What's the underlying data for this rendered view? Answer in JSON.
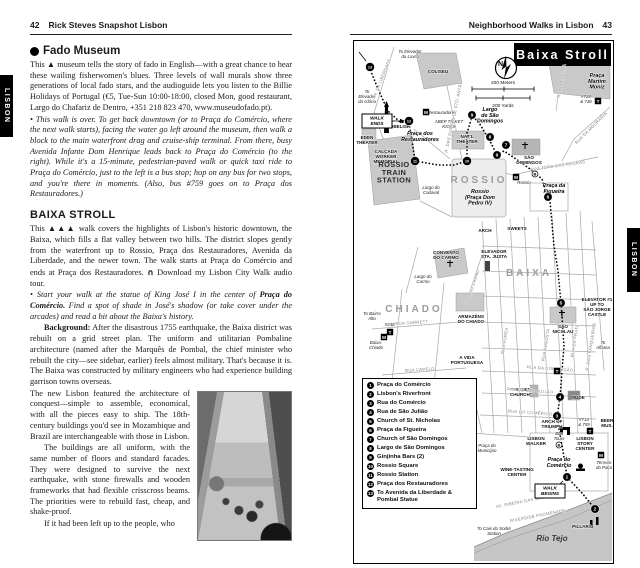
{
  "colors": {
    "ink": "#1a1a1a",
    "paper": "#ffffff",
    "map_building_gray": "#c9c9c9",
    "river_gray": "#c6c6c6",
    "tab_black": "#000000"
  },
  "page_left": {
    "page_number": "42",
    "header": "Rick Steves Snapshot Lisbon",
    "side_tab": "LISBON",
    "fado": {
      "marker_icon": "filled-circle",
      "title": "Fado Museum",
      "body": "This ▲ museum tells the story of fado in English—with a great chance to hear these wailing fisherwomen's blues. Three levels of wall murals show three generations of local fado stars, and the audioguide lets you listen to the Billie Holidays of Portugal (€5, Tue-Sun 10:00-18:00, closed Mon, good restaurant, Largo do Chafariz de Dentro, +351 218 823 470, www.museudofado.pt).",
      "walk_note": "• This walk is over. To get back downtown (or to Praça do Comércio, where the next walk starts), facing the water go left around the museum, then walk a block to the main waterfront drag and cruise-ship terminal. From there, busy Avenida Infante Dom Henrique leads back to Praça do Comércio (to the right). While it's a 15-minute, pedestrian-paved walk or quick taxi ride to Praça do Comércio, just to the left is a bus stop; hop on any bus for two stops, and you're there in moments. (Also, bus #759 goes on to Praça dos Restauradores.)"
    },
    "baixa": {
      "title": "BAIXA STROLL",
      "intro": "This ▲▲▲ walk covers the highlights of Lisbon's historic downtown, the Baixa, which fills a flat valley between two hills. The district slopes gently from the waterfront up to Rossio, Praça dos Restauradores, Avenida da Liberdade, and the newer town. The walk starts at Praça do Comércio and ends at Praça dos Restauradores. ",
      "audio_icon": "∩",
      "audio_text": " Download my Lisbon City Walk audio tour.",
      "start_pre": "• Start your walk at the statue of King José I in the center of ",
      "start_bold": "Praça do Comércio.",
      "start_post": " Find a spot of shade in José's shadow (or take cover under the arcades) and read a bit about the Baixa's history.",
      "background_label": "Background:",
      "background_body": " After the disastrous 1755 earthquake, the Baixa district was rebuilt on a grid street plan. The uniform and utilitarian Pombaline architecture (named after the Marquês de Pombal, the chief minister who rebuilt the city—see sidebar, earlier) feels almost military. That's because it is. The Baixa was constructed by military engineers who had experience building garrison towns overseas.",
      "para_new_lisbon": "The new Lisbon featured the architecture of conquest—simple to assemble, economical, with all the pieces easy to ship. The 18th-century buildings you'd see in Mozambique and Brazil are interchangeable with those in Lisbon.",
      "para_uniform": "The buildings are all uniform, with the same number of floors and standard facades. They were designed to survive the next earthquake, with stone firewalls and wooden frameworks that had flexible crisscross beams. The priorities were to rebuild fast, cheap, and shake-proof.",
      "para_last": "If it had been left up to the people, who"
    }
  },
  "page_right": {
    "header": "Neighborhood Walks in Lisbon",
    "page_number": "43",
    "side_tab": "LISBON",
    "map": {
      "title": "Baixa Stroll",
      "compass": "N",
      "scale_meters": "200 Meters",
      "scale_yards": "200 Yards",
      "river_label": "Rio Tejo",
      "legend": [
        {
          "n": "1",
          "label": "Praça do Comércio"
        },
        {
          "n": "2",
          "label": "Lisbon's Riverfront"
        },
        {
          "n": "3",
          "label": "Rua do Comércio"
        },
        {
          "n": "4",
          "label": "Rua de São Julião"
        },
        {
          "n": "5",
          "label": "Church of St. Nicholas"
        },
        {
          "n": "6",
          "label": "Praça da Figueira"
        },
        {
          "n": "7",
          "label": "Church of São Domingos"
        },
        {
          "n": "8",
          "label": "Largo de São Domingos"
        },
        {
          "n": "9",
          "label": "Ginjinha Bars (2)"
        },
        {
          "n": "10",
          "label": "Rossio Square"
        },
        {
          "n": "11",
          "label": "Rossio Station"
        },
        {
          "n": "12",
          "label": "Praça dos Restauradores"
        },
        {
          "n": "13",
          "label": "To Avenida da Liberdade & Pombal Statue"
        }
      ],
      "stops": [
        {
          "n": "1",
          "x": 213,
          "y": 436
        },
        {
          "n": "2",
          "x": 241,
          "y": 468
        },
        {
          "n": "3",
          "x": 203,
          "y": 375
        },
        {
          "n": "4",
          "x": 206,
          "y": 356
        },
        {
          "n": "5",
          "x": 207,
          "y": 262
        },
        {
          "n": "6",
          "x": 194,
          "y": 156
        },
        {
          "n": "7",
          "x": 152,
          "y": 104
        },
        {
          "n": "8",
          "x": 136,
          "y": 96
        },
        {
          "n": "9",
          "x": 118,
          "y": 74
        },
        {
          "n": "9",
          "x": 143,
          "y": 114
        },
        {
          "n": "10",
          "x": 113,
          "y": 120
        },
        {
          "n": "11",
          "x": 61,
          "y": 120
        },
        {
          "n": "12",
          "x": 55,
          "y": 80
        },
        {
          "n": "13",
          "x": 16,
          "y": 26
        }
      ],
      "boxes": [
        {
          "t": "WALK\nENDS",
          "x": 23,
          "y": 80
        },
        {
          "t": "WALK\nBEGINS",
          "x": 196,
          "y": 450
        }
      ],
      "symbols": [
        {
          "k": "M",
          "x": 72,
          "y": 71
        },
        {
          "k": "M",
          "x": 162,
          "y": 136
        },
        {
          "k": "M",
          "x": 30,
          "y": 296
        },
        {
          "k": "M",
          "x": 247,
          "y": 414
        },
        {
          "k": "T",
          "x": 244,
          "y": 60
        },
        {
          "k": "T",
          "x": 203,
          "y": 330
        },
        {
          "k": "T",
          "x": 236,
          "y": 390
        },
        {
          "k": "T",
          "x": 36,
          "y": 291
        },
        {
          "k": "B",
          "x": 205,
          "y": 404
        },
        {
          "k": "B",
          "x": 181,
          "y": 133
        }
      ],
      "labels": [
        {
          "t": "To Elevador\nda Lavra",
          "x": 56,
          "y": 12,
          "c": "it"
        },
        {
          "t": "COLISEU",
          "x": 84,
          "y": 32,
          "c": "poi"
        },
        {
          "t": "To\nElevador\nda Glória",
          "x": 13,
          "y": 52,
          "c": "it"
        },
        {
          "t": "OBELISK",
          "x": 46,
          "y": 87,
          "c": "poi"
        },
        {
          "t": "Praça dos\nRestauradores",
          "x": 66,
          "y": 94,
          "c": "sq"
        },
        {
          "t": "EDEN\nTHEATER",
          "x": 13,
          "y": 98,
          "c": "poi"
        },
        {
          "t": "CALÇADA\nWORKER\nMEMORIAL",
          "x": 32,
          "y": 112,
          "c": "poi"
        },
        {
          "t": "ROSSIO\nTRAIN\nSTATION",
          "x": 40,
          "y": 126,
          "c": "big2"
        },
        {
          "t": "Largo do\nCadaval",
          "x": 77,
          "y": 148,
          "c": "it"
        },
        {
          "t": "NAT'L\nTHEATER",
          "x": 113,
          "y": 97,
          "c": "poi"
        },
        {
          "t": "ROSSIO",
          "x": 125,
          "y": 142,
          "c": "big"
        },
        {
          "t": "Rossio\n(Praça Dom\nPedro IV)",
          "x": 126,
          "y": 152,
          "c": "sq"
        },
        {
          "t": "SÃO\nDOMINGOS",
          "x": 175,
          "y": 118,
          "c": "poi"
        },
        {
          "t": "Largo\nde São\nDomingos",
          "x": 136,
          "y": 70,
          "c": "sq"
        },
        {
          "t": "Praça da\nFigueira",
          "x": 200,
          "y": 146,
          "c": "sq"
        },
        {
          "t": "Praça\nMartim\nMoniz",
          "x": 243,
          "y": 36,
          "c": "sq"
        },
        {
          "t": "#728\n& 736",
          "x": 232,
          "y": 57,
          "c": "it"
        },
        {
          "t": "ABEP TICKET\nKIOSK",
          "x": 95,
          "y": 82,
          "c": "it"
        },
        {
          "t": "Restauradores",
          "x": 88,
          "y": 73,
          "c": "it"
        },
        {
          "t": "Rossio",
          "x": 170,
          "y": 143,
          "c": "it"
        },
        {
          "t": "SWEETS",
          "x": 163,
          "y": 189,
          "c": "poi"
        },
        {
          "t": "ARCH",
          "x": 131,
          "y": 191,
          "c": "poi"
        },
        {
          "t": "CONVENTO\nDO CARMO",
          "x": 92,
          "y": 213,
          "c": "poi"
        },
        {
          "t": "Largo do\nCarmo",
          "x": 69,
          "y": 237,
          "c": "it"
        },
        {
          "t": "ELEVADOR\nSTA. JUSTA",
          "x": 140,
          "y": 212,
          "c": "poi"
        },
        {
          "t": "BAIXA",
          "x": 175,
          "y": 235,
          "c": "big"
        },
        {
          "t": "CHIADO",
          "x": 60,
          "y": 271,
          "c": "big"
        },
        {
          "t": "ARMAZÉNS\nDO CHIADO",
          "x": 117,
          "y": 277,
          "c": "poi"
        },
        {
          "t": "To Bairro\nAlto",
          "x": 18,
          "y": 274,
          "c": "it"
        },
        {
          "t": "#24E",
          "x": 36,
          "y": 285,
          "c": "it"
        },
        {
          "t": "Baixa-\nChiado",
          "x": 22,
          "y": 303,
          "c": "it"
        },
        {
          "t": "A VIDA\nPORTUGUESA",
          "x": 113,
          "y": 318,
          "c": "poi"
        },
        {
          "t": "SÃO\nNICOLAU",
          "x": 209,
          "y": 287,
          "c": "poi"
        },
        {
          "t": "ELEVATOR #1\nUP TO\nSÃO JORGE\nCASTLE",
          "x": 243,
          "y": 260,
          "c": "poi"
        },
        {
          "t": "To\nAlfama",
          "x": 249,
          "y": 303,
          "c": "it"
        },
        {
          "t": "“HIDDEN\nCHURCH”",
          "x": 167,
          "y": 350,
          "c": "poi"
        },
        {
          "t": "MUDE",
          "x": 224,
          "y": 358,
          "c": "poi"
        },
        {
          "t": "ARCH OF\nTRIUMPH",
          "x": 198,
          "y": 382,
          "c": "poi"
        },
        {
          "t": "#714\n& 759",
          "x": 230,
          "y": 380,
          "c": "it"
        },
        {
          "t": "BEER\nMUS.",
          "x": 253,
          "y": 381,
          "c": "poi"
        },
        {
          "t": "LISBON\nWALKER",
          "x": 182,
          "y": 399,
          "c": "poi"
        },
        {
          "t": "Bus\nTours",
          "x": 205,
          "y": 394,
          "c": "it"
        },
        {
          "t": "LISBON\nSTORY\nCENTER",
          "x": 231,
          "y": 399,
          "c": "poi"
        },
        {
          "t": "Praça do\nComércio",
          "x": 205,
          "y": 420,
          "c": "sq"
        },
        {
          "t": "Terreiro\ndo Paço",
          "x": 250,
          "y": 423,
          "c": "it"
        },
        {
          "t": "Praça do\nMunicípio",
          "x": 133,
          "y": 406,
          "c": "it"
        },
        {
          "t": "WINE-TASTING\nCENTER",
          "x": 163,
          "y": 430,
          "c": "poi"
        },
        {
          "t": "PILLARS",
          "x": 228,
          "y": 487,
          "c": "poi"
        },
        {
          "t": "Rio Tejo",
          "x": 198,
          "y": 500,
          "c": "river"
        },
        {
          "t": "To Cais do Sodré\nStation",
          "x": 140,
          "y": 489,
          "c": "it"
        },
        {
          "t": "RIVERSIDE PROMENADE",
          "x": 184,
          "y": 476,
          "c": "st",
          "r": -11
        },
        {
          "t": "AV. RIBEIRA DAS NAUS",
          "x": 168,
          "y": 462,
          "c": "st",
          "r": -11
        },
        {
          "t": "RUA DA CONCEIÇÃO",
          "x": 196,
          "y": 329,
          "c": "st",
          "r": 4
        },
        {
          "t": "RUA DE SÃO JULIÃO",
          "x": 176,
          "y": 351,
          "c": "st",
          "r": 4
        },
        {
          "t": "RUA DO COMÉRCIO",
          "x": 176,
          "y": 373,
          "c": "st",
          "r": 4
        },
        {
          "t": "RUA ÁUREA",
          "x": 152,
          "y": 300,
          "c": "st",
          "r": -81
        },
        {
          "t": "RUA AUGUSTA",
          "x": 193,
          "y": 304,
          "c": "st",
          "r": -81
        },
        {
          "t": "RUA DA PRATA",
          "x": 222,
          "y": 300,
          "c": "st",
          "r": -81
        },
        {
          "t": "R. DOS FANQUEIROS",
          "x": 238,
          "y": 306,
          "c": "st",
          "r": -81
        },
        {
          "t": "RUA DO CARMO",
          "x": 120,
          "y": 246,
          "c": "st",
          "r": -72
        },
        {
          "t": "RUA DA PALMA",
          "x": 209,
          "y": 40,
          "c": "st",
          "r": -80
        },
        {
          "t": "RUA DA MOURARIA",
          "x": 238,
          "y": 88,
          "c": "st",
          "r": -45
        },
        {
          "t": "R. DAS PORTAS DE STO. ANTÃO",
          "x": 101,
          "y": 76,
          "c": "st",
          "r": -78
        },
        {
          "t": "AV. DA LIBERDADE",
          "x": 29,
          "y": 38,
          "c": "st",
          "r": -68
        },
        {
          "t": "RUA JOÃO DAS REGRAS",
          "x": 204,
          "y": 126,
          "c": "st",
          "r": -8
        },
        {
          "t": "RUA GARRETT",
          "x": 58,
          "y": 283,
          "c": "st",
          "r": -4
        },
        {
          "t": "RUA CAPELO",
          "x": 66,
          "y": 330,
          "c": "st",
          "r": -4
        }
      ]
    }
  }
}
